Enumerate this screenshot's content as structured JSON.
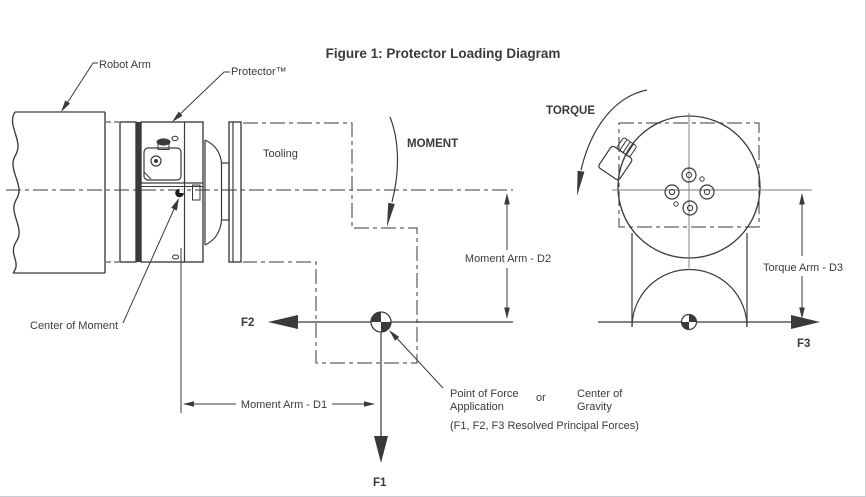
{
  "figure": {
    "title": "Figure 1: Protector Loading Diagram"
  },
  "labels": {
    "robot_arm": "Robot Arm",
    "protector": "Protector™",
    "tooling": "Tooling",
    "moment": "MOMENT",
    "torque": "TORQUE",
    "center_of_moment": "Center of Moment",
    "moment_arm_d1": "Moment Arm - D1",
    "moment_arm_d2": "Moment Arm - D2",
    "torque_arm_d3": "Torque Arm - D3",
    "force_f1": "F1",
    "force_f2": "F2",
    "force_f3": "F3",
    "point_of_force_line1": "Point of Force",
    "point_of_force_line2": "Application",
    "or_word": "or",
    "center_of_gravity_line1": "Center of",
    "center_of_gravity_line2": "Gravity",
    "resolved_forces_note": "(F1, F2, F3 Resolved Principal Forces)"
  },
  "colors": {
    "line": "#3a3a3a",
    "thin": "#787878",
    "bg": "#ffffff",
    "edge": "#c9ced6"
  }
}
